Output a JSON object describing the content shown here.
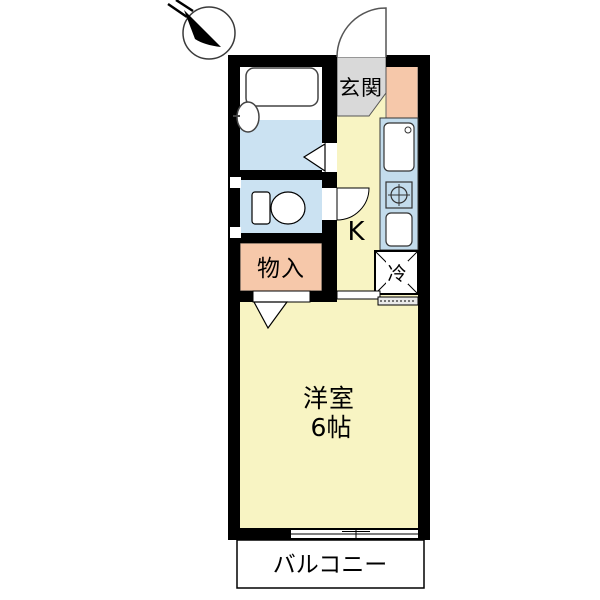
{
  "plan_title": "one-room-apartment-floor-plan",
  "compass": {
    "icon": "north-arrow"
  },
  "floor_plan": {
    "wall_color": "#000000",
    "entrance": {
      "label": "玄関",
      "floor_color": "#d9d9d9"
    },
    "hall_strip": {
      "floor_color": "#f6c8aa"
    },
    "kitchen": {
      "label": "K",
      "floor_color": "#f8f4c3"
    },
    "kitchen_unit": {
      "color": "#c3dcec",
      "fixtures": [
        "sink",
        "stove-burner",
        "counter"
      ]
    },
    "refrigerator_space": {
      "label": "冷"
    },
    "bathroom": {
      "floor_color": "#cbe2f2",
      "fixtures": [
        "bathtub",
        "faucet"
      ]
    },
    "toilet_room": {
      "floor_color": "#cbe2f2",
      "fixtures": [
        "toilet"
      ]
    },
    "storage": {
      "label": "物入",
      "floor_color": "#f6c8aa"
    },
    "western_room": {
      "label": "洋室",
      "size": "6帖",
      "floor_color": "#f8f4c3"
    },
    "balcony": {
      "label": "バルコニー",
      "floor_color": "#ffffff"
    }
  }
}
